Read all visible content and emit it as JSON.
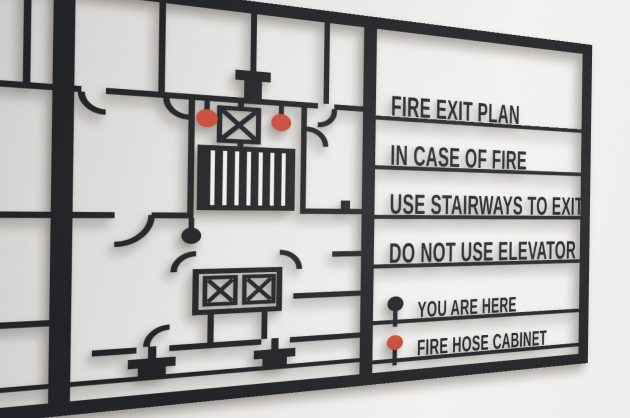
{
  "sign": {
    "messages": [
      "FIRE EXIT PLAN",
      "IN CASE OF FIRE",
      "USE STAIRWAYS TO EXIT",
      "DO NOT USE ELEVATOR"
    ],
    "legend": [
      {
        "label": "YOU ARE HERE",
        "marker": "location-pin",
        "color": "#232428"
      },
      {
        "label": "FIRE HOSE CABINET",
        "marker": "location-pin",
        "color": "#c84b38"
      }
    ],
    "plan": {
      "fire_hose_pins": 2,
      "you_are_here_pins": 1,
      "elevator_boxes": 2,
      "stair_exit_boxes": 1
    },
    "colors": {
      "ink": "#232428",
      "accent": "#c84b38",
      "panel": "#f0efed",
      "wall_light": "#f3f2f0",
      "wall_dark": "#d2d1cf"
    }
  }
}
